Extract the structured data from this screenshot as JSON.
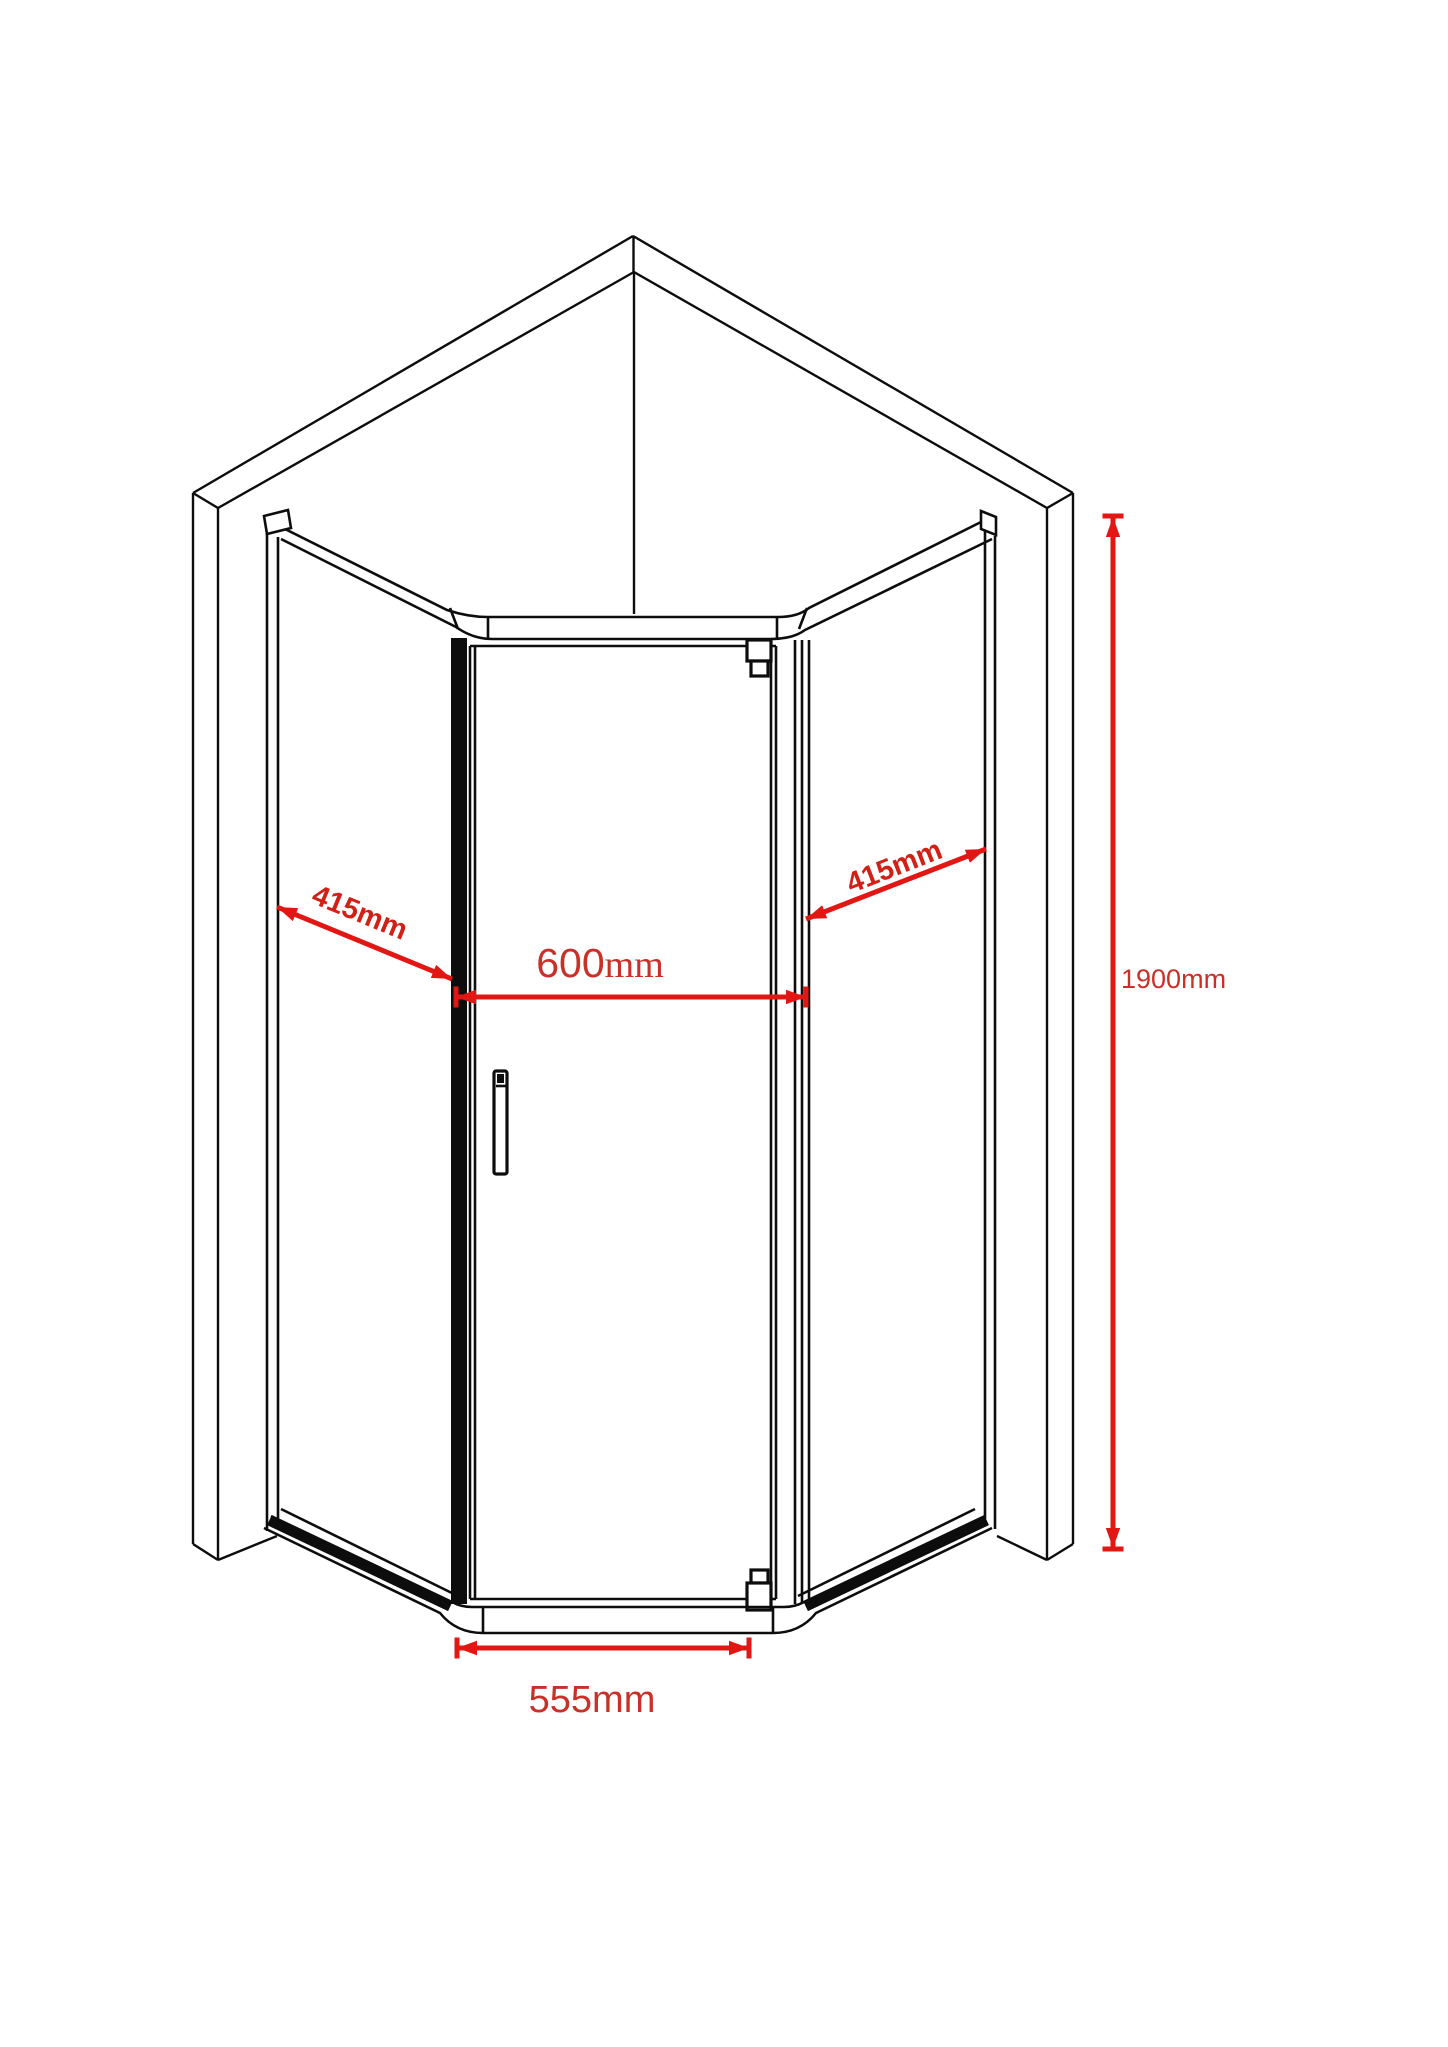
{
  "diagram": {
    "annotations": {
      "left_side": {
        "value": "415",
        "unit": "mm"
      },
      "right_side": {
        "value": "415",
        "unit": "mm"
      },
      "door_width": {
        "value": "600",
        "unit": "mm"
      },
      "base_width": {
        "value": "555",
        "unit": "mm"
      },
      "height": {
        "value": "1900",
        "unit": "mm"
      }
    },
    "colors": {
      "linework": "#0d0d0d",
      "dimension_line": "#e21713",
      "dimension_text": "#c93028",
      "dimension_text_bold": "#d32017",
      "background": "#ffffff"
    }
  }
}
